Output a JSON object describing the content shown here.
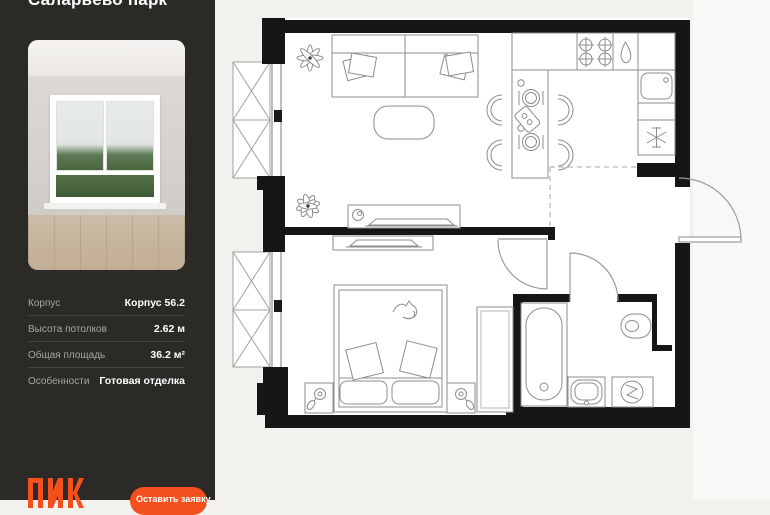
{
  "sidebar": {
    "title": "Саларьево парк",
    "specs": [
      {
        "label": "Корпус",
        "value": "Корпус 56.2"
      },
      {
        "label": "Высота потолков",
        "value": "2.62 м"
      },
      {
        "label": "Общая площадь",
        "value": "36.2 м²"
      },
      {
        "label": "Особенности",
        "value": "Готовая отделка"
      }
    ],
    "logo_text": "ПИК",
    "cta_label": "Оставить заявку"
  },
  "plan": {
    "rooms": [
      "living-room",
      "kitchen",
      "hallway",
      "bedroom",
      "bathroom",
      "balcony-living",
      "balcony-bedroom"
    ],
    "fixtures": [
      "sofa",
      "coffee-table",
      "plant",
      "tv-console",
      "dining-table",
      "chairs",
      "stove",
      "kitchen-sink",
      "fridge",
      "bed",
      "cat",
      "nightstand-lamps",
      "wardrobe",
      "bathtub",
      "washbasin",
      "washing-machine",
      "toilet",
      "entrance-door",
      "bedroom-door",
      "bathroom-door"
    ]
  },
  "colors": {
    "accent": "#F4501E",
    "sidebar_bg": "#2B2A27",
    "plan_bg": "#F2F1EE",
    "wall": "#161616"
  }
}
